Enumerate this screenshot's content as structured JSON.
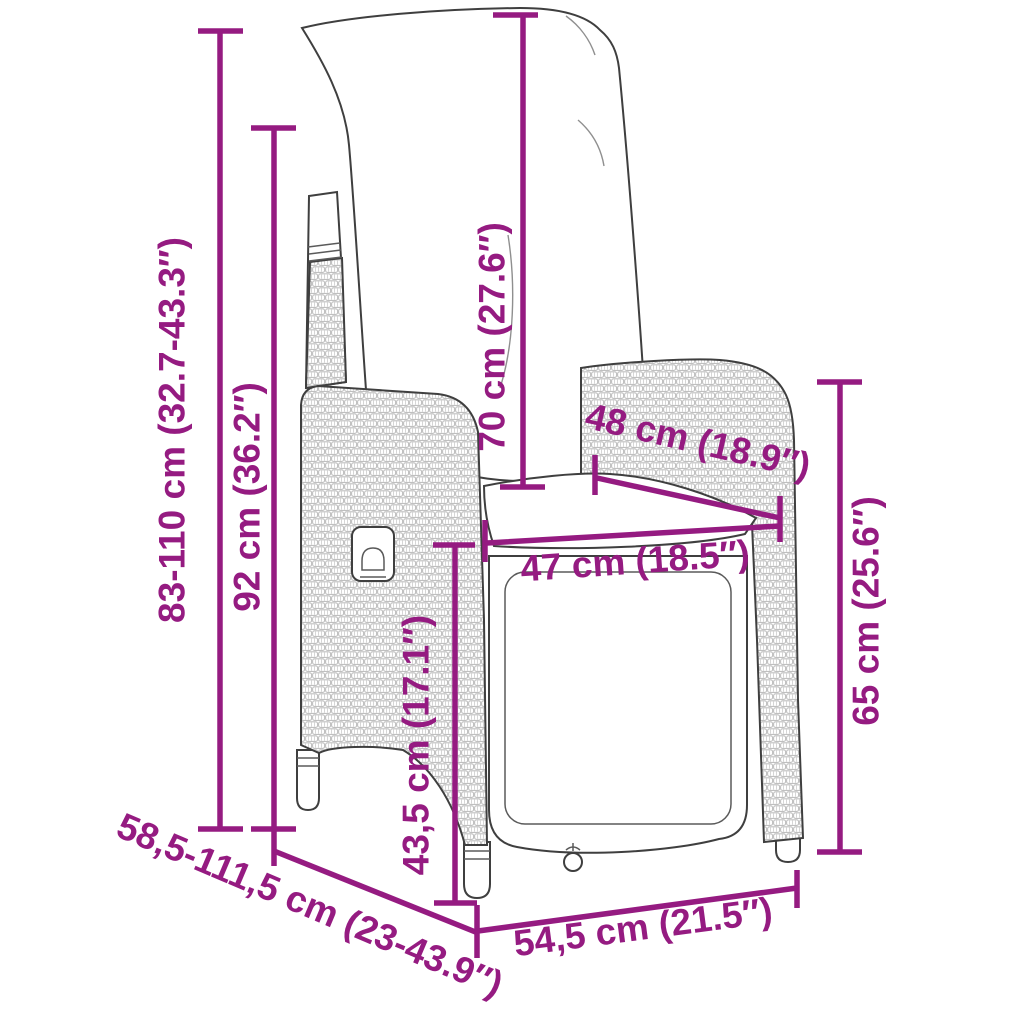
{
  "figure": {
    "description": "Dimension diagram of a reclining poly rattan garden chair with cushions",
    "accent_color": "#951B81",
    "line_art_color": "#3F3F3F",
    "wicker_texture_color": "#C4C4C4",
    "background_color": "#FFFFFF"
  },
  "dimensions": {
    "total_height": "83-110 cm (32.7-43.3″)",
    "back_height": "92 cm (36.2″)",
    "cushion_length": "70 cm (27.6″)",
    "back_width": "48 cm (18.9″)",
    "seat_width": "47 cm (18.5″)",
    "armrest_height": "65 cm (25.6″)",
    "seat_front_height": "43,5 cm (17.1″)",
    "total_depth_range": "58,5-111,5 cm (23-43.9″)",
    "base_width": "54,5 cm (21.5″)"
  }
}
